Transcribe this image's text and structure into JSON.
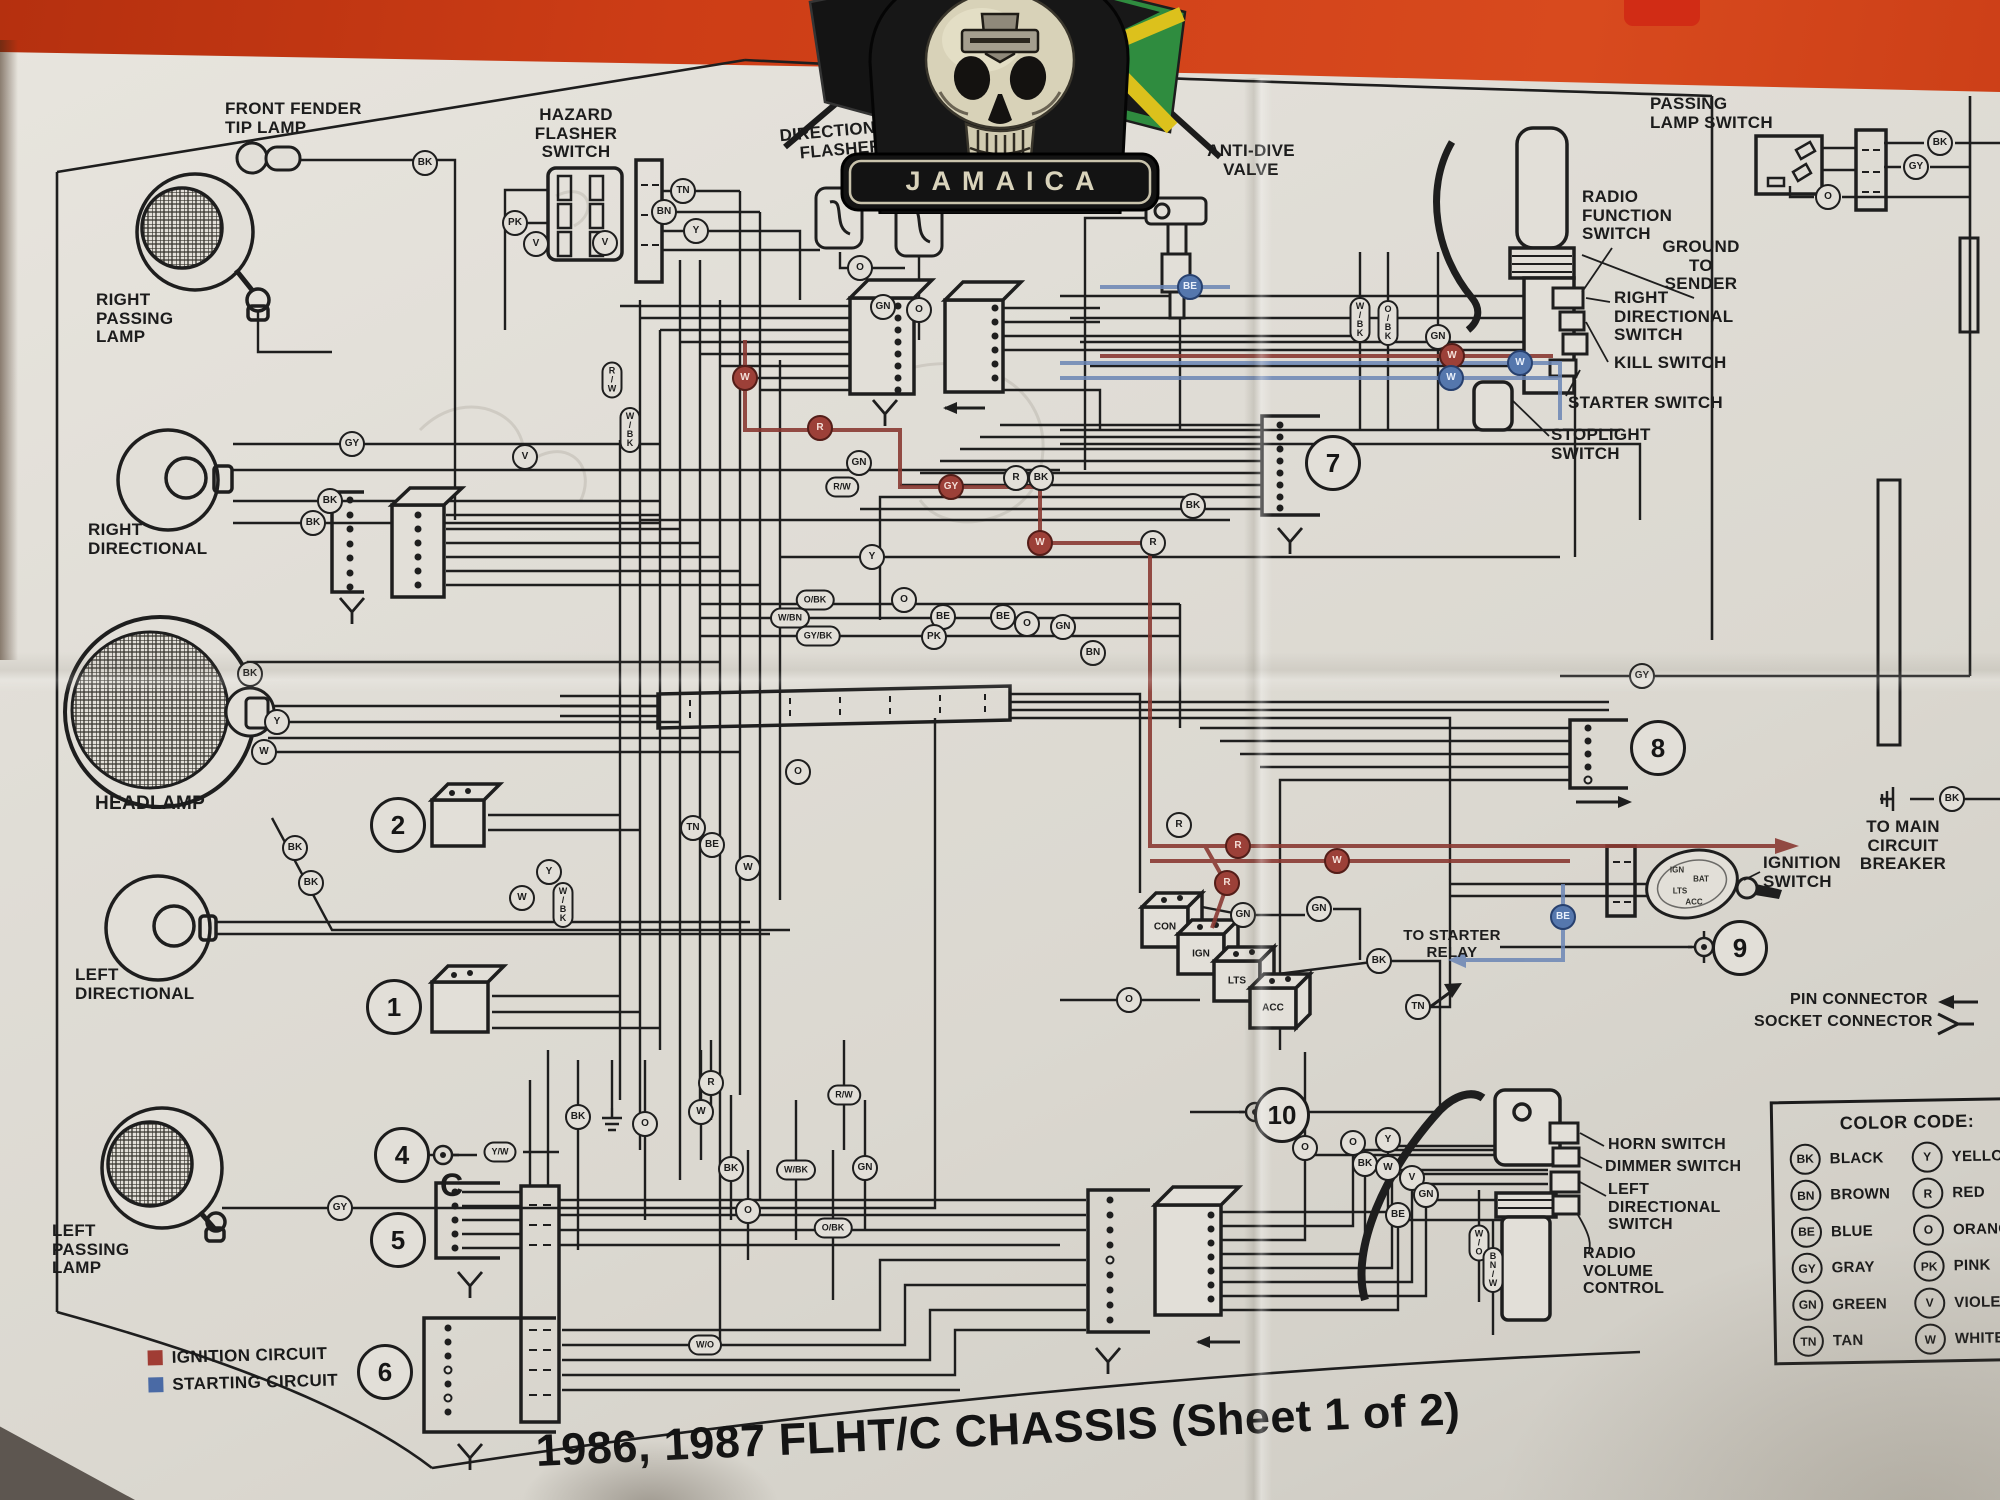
{
  "photo": {
    "background_color": "#cd3d16",
    "paper_color": "#e0ddd6",
    "ink_color": "#1e1e1e"
  },
  "patch": {
    "banner_text": "JAMAICA"
  },
  "title": {
    "text": "1986, 1987 FLHT/C CHASSIS (Sheet 1 of 2)"
  },
  "legend": {
    "items": [
      {
        "label": "IGNITION CIRCUIT",
        "color": "#a03c34"
      },
      {
        "label": "STARTING CIRCUIT",
        "color": "#4a6aa5"
      }
    ]
  },
  "color_code": {
    "title": "COLOR CODE:",
    "left": [
      [
        "BK",
        "BLACK"
      ],
      [
        "BN",
        "BROWN"
      ],
      [
        "BE",
        "BLUE"
      ],
      [
        "GY",
        "GRAY"
      ],
      [
        "GN",
        "GREEN"
      ],
      [
        "TN",
        "TAN"
      ]
    ],
    "right": [
      [
        "Y",
        "YELLOW"
      ],
      [
        "R",
        "RED"
      ],
      [
        "O",
        "ORANGE"
      ],
      [
        "PK",
        "PINK"
      ],
      [
        "V",
        "VIOLET"
      ],
      [
        "W",
        "WHITE"
      ]
    ]
  },
  "ignition_switch": {
    "terminals": [
      "IGN",
      "BAT",
      "LTS",
      "ACC"
    ]
  },
  "key_switch_terminals": [
    "CON",
    "IGN",
    "LTS",
    "ACC"
  ],
  "component_labels": [
    {
      "n": "front-fender-tip-lamp-label",
      "t": "FRONT FENDER\nTIP LAMP",
      "x": 225,
      "y": 100,
      "fs": 17,
      "al": "l"
    },
    {
      "n": "hazard-flasher-switch-label",
      "t": "HAZARD\nFLASHER\nSWITCH",
      "x": 576,
      "y": 106,
      "fs": 17,
      "al": "c"
    },
    {
      "n": "directional-flasher-label",
      "t": "DIRECTIONAL\nFLASHER",
      "x": 840,
      "y": 122,
      "fs": 17,
      "al": "c",
      "rot": -5
    },
    {
      "n": "hazard-flasher-label",
      "t": "HAZARD\nFLASHER",
      "x": 950,
      "y": 134,
      "fs": 17,
      "al": "c",
      "rot": -7
    },
    {
      "n": "anti-dive-valve-label",
      "t": "ANTI-DIVE\nVALVE",
      "x": 1251,
      "y": 142,
      "fs": 17,
      "al": "c"
    },
    {
      "n": "passing-lamp-switch-label",
      "t": "PASSING\nLAMP SWITCH",
      "x": 1650,
      "y": 95,
      "fs": 17,
      "al": "l"
    },
    {
      "n": "radio-function-switch-label",
      "t": "RADIO\nFUNCTION\nSWITCH",
      "x": 1582,
      "y": 188,
      "fs": 17,
      "al": "l"
    },
    {
      "n": "ground-to-sender-label",
      "t": "GROUND\nTO\nSENDER",
      "x": 1701,
      "y": 238,
      "fs": 17,
      "al": "c"
    },
    {
      "n": "right-directional-switch-label",
      "t": "RIGHT\nDIRECTIONAL\nSWITCH",
      "x": 1614,
      "y": 289,
      "fs": 17,
      "al": "l"
    },
    {
      "n": "kill-switch-label",
      "t": "KILL SWITCH",
      "x": 1614,
      "y": 354,
      "fs": 17,
      "al": "l"
    },
    {
      "n": "starter-switch-label",
      "t": "STARTER SWITCH",
      "x": 1568,
      "y": 394,
      "fs": 17,
      "al": "l"
    },
    {
      "n": "stoplight-switch-label",
      "t": "STOPLIGHT\nSWITCH",
      "x": 1551,
      "y": 426,
      "fs": 17,
      "al": "l"
    },
    {
      "n": "right-passing-lamp-label",
      "t": "RIGHT\nPASSING\nLAMP",
      "x": 96,
      "y": 291,
      "fs": 17,
      "al": "l"
    },
    {
      "n": "right-directional-label",
      "t": "RIGHT\nDIRECTIONAL",
      "x": 88,
      "y": 521,
      "fs": 17,
      "al": "l"
    },
    {
      "n": "headlamp-label",
      "t": "HEADLAMP",
      "x": 95,
      "y": 794,
      "fs": 19,
      "al": "l"
    },
    {
      "n": "left-directional-label",
      "t": "LEFT\nDIRECTIONAL",
      "x": 75,
      "y": 966,
      "fs": 17,
      "al": "l"
    },
    {
      "n": "left-passing-lamp-label",
      "t": "LEFT\nPASSING\nLAMP",
      "x": 52,
      "y": 1222,
      "fs": 17,
      "al": "l"
    },
    {
      "n": "horn-switch-label",
      "t": "HORN SWITCH",
      "x": 1608,
      "y": 1136,
      "fs": 16,
      "al": "l"
    },
    {
      "n": "dimmer-switch-label",
      "t": "DIMMER SWITCH",
      "x": 1605,
      "y": 1158,
      "fs": 16,
      "al": "l"
    },
    {
      "n": "left-directional-switch-label",
      "t": "LEFT\nDIRECTIONAL\nSWITCH",
      "x": 1608,
      "y": 1181,
      "fs": 16,
      "al": "l"
    },
    {
      "n": "radio-volume-control-label",
      "t": "RADIO\nVOLUME\nCONTROL",
      "x": 1583,
      "y": 1245,
      "fs": 16,
      "al": "l"
    },
    {
      "n": "to-main-circuit-breaker-label",
      "t": "TO MAIN\nCIRCUIT BREAKER",
      "x": 1903,
      "y": 818,
      "fs": 17,
      "al": "c"
    },
    {
      "n": "ignition-switch-label",
      "t": "IGNITION\nSWITCH",
      "x": 1763,
      "y": 854,
      "fs": 17,
      "al": "l"
    },
    {
      "n": "pin-connector-label",
      "t": "PIN CONNECTOR",
      "x": 1790,
      "y": 991,
      "fs": 16,
      "al": "l"
    },
    {
      "n": "socket-connector-label",
      "t": "SOCKET CONNECTOR",
      "x": 1754,
      "y": 1013,
      "fs": 16,
      "al": "l"
    },
    {
      "n": "to-starter-relay-label",
      "t": "TO STARTER\nRELAY",
      "x": 1452,
      "y": 928,
      "fs": 15,
      "al": "c"
    },
    {
      "n": "c-marker",
      "t": "C",
      "x": 440,
      "y": 1168,
      "fs": 32,
      "al": "l"
    }
  ],
  "wire_labels": [
    {
      "c": "BK",
      "x": 425,
      "y": 163
    },
    {
      "c": "PK",
      "x": 515,
      "y": 223
    },
    {
      "c": "V",
      "x": 536,
      "y": 244
    },
    {
      "c": "V",
      "x": 605,
      "y": 243
    },
    {
      "c": "TN",
      "x": 683,
      "y": 191
    },
    {
      "c": "BN",
      "x": 664,
      "y": 212
    },
    {
      "c": "Y",
      "x": 696,
      "y": 231
    },
    {
      "c": "O",
      "x": 860,
      "y": 268
    },
    {
      "c": "GN",
      "x": 883,
      "y": 307
    },
    {
      "c": "O",
      "x": 919,
      "y": 310
    },
    {
      "c": "BK",
      "x": 1940,
      "y": 143
    },
    {
      "c": "GY",
      "x": 1916,
      "y": 167
    },
    {
      "c": "O",
      "x": 1828,
      "y": 197
    },
    {
      "c": "GY",
      "x": 352,
      "y": 444
    },
    {
      "c": "BK",
      "x": 330,
      "y": 501
    },
    {
      "c": "BK",
      "x": 313,
      "y": 523
    },
    {
      "c": "V",
      "x": 525,
      "y": 457
    },
    {
      "c": "BK",
      "x": 250,
      "y": 674
    },
    {
      "c": "Y",
      "x": 277,
      "y": 722
    },
    {
      "c": "W",
      "x": 264,
      "y": 752
    },
    {
      "c": "BK",
      "x": 295,
      "y": 848
    },
    {
      "c": "BK",
      "x": 311,
      "y": 883
    },
    {
      "c": "GY",
      "x": 340,
      "y": 1208
    },
    {
      "c": "Y",
      "x": 549,
      "y": 872
    },
    {
      "c": "W",
      "x": 522,
      "y": 898
    },
    {
      "c": "TN",
      "x": 693,
      "y": 828
    },
    {
      "c": "O",
      "x": 798,
      "y": 772
    },
    {
      "c": "BE",
      "x": 712,
      "y": 845
    },
    {
      "c": "W",
      "x": 748,
      "y": 868
    },
    {
      "c": "GN",
      "x": 859,
      "y": 463
    },
    {
      "c": "Y",
      "x": 872,
      "y": 557
    },
    {
      "c": "O",
      "x": 904,
      "y": 600
    },
    {
      "c": "BE",
      "x": 943,
      "y": 617
    },
    {
      "c": "PK",
      "x": 934,
      "y": 637
    },
    {
      "c": "BE",
      "x": 1003,
      "y": 617
    },
    {
      "c": "O",
      "x": 1027,
      "y": 624
    },
    {
      "c": "GN",
      "x": 1063,
      "y": 627
    },
    {
      "c": "BN",
      "x": 1093,
      "y": 653
    },
    {
      "c": "R",
      "x": 1016,
      "y": 478
    },
    {
      "c": "BK",
      "x": 1041,
      "y": 478
    },
    {
      "c": "BK",
      "x": 1193,
      "y": 506
    },
    {
      "c": "R",
      "x": 1153,
      "y": 543
    },
    {
      "c": "GN",
      "x": 1438,
      "y": 337
    },
    {
      "c": "R",
      "x": 1179,
      "y": 825
    },
    {
      "c": "GN",
      "x": 1243,
      "y": 915
    },
    {
      "c": "GN",
      "x": 1319,
      "y": 909
    },
    {
      "c": "BK",
      "x": 1379,
      "y": 961
    },
    {
      "c": "O",
      "x": 1129,
      "y": 1000
    },
    {
      "c": "TN",
      "x": 1418,
      "y": 1007
    },
    {
      "c": "BK",
      "x": 1952,
      "y": 799
    },
    {
      "c": "GY",
      "x": 1642,
      "y": 676
    },
    {
      "c": "O",
      "x": 1305,
      "y": 1148
    },
    {
      "c": "O",
      "x": 1353,
      "y": 1143
    },
    {
      "c": "Y",
      "x": 1388,
      "y": 1140
    },
    {
      "c": "BK",
      "x": 1365,
      "y": 1164
    },
    {
      "c": "W",
      "x": 1388,
      "y": 1168
    },
    {
      "c": "V",
      "x": 1412,
      "y": 1178
    },
    {
      "c": "GN",
      "x": 1426,
      "y": 1195
    },
    {
      "c": "BE",
      "x": 1398,
      "y": 1215
    },
    {
      "c": "BK",
      "x": 578,
      "y": 1117
    },
    {
      "c": "O",
      "x": 645,
      "y": 1124
    },
    {
      "c": "W",
      "x": 701,
      "y": 1112
    },
    {
      "c": "R",
      "x": 711,
      "y": 1083
    },
    {
      "c": "BK",
      "x": 731,
      "y": 1169
    },
    {
      "c": "GN",
      "x": 865,
      "y": 1168
    },
    {
      "c": "O",
      "x": 748,
      "y": 1211
    },
    {
      "c": "R/W",
      "x": 842,
      "y": 487,
      "s": "p"
    },
    {
      "c": "Y/W",
      "x": 500,
      "y": 1152,
      "s": "p"
    },
    {
      "c": "W/O",
      "x": 705,
      "y": 1345,
      "s": "p"
    },
    {
      "c": "R/W",
      "x": 844,
      "y": 1095,
      "s": "p"
    },
    {
      "c": "W/BK",
      "x": 796,
      "y": 1170,
      "s": "p"
    },
    {
      "c": "O/BK",
      "x": 833,
      "y": 1228,
      "s": "p"
    },
    {
      "c": "O/BK",
      "x": 815,
      "y": 600,
      "s": "p"
    },
    {
      "c": "W/BN",
      "x": 790,
      "y": 618,
      "s": "p"
    },
    {
      "c": "GY/BK",
      "x": 818,
      "y": 636,
      "s": "p"
    },
    {
      "c": "W/BK",
      "x": 1360,
      "y": 320,
      "s": "v"
    },
    {
      "c": "O/BK",
      "x": 1388,
      "y": 323,
      "s": "v"
    },
    {
      "c": "W/O",
      "x": 1479,
      "y": 1243,
      "s": "v"
    },
    {
      "c": "BN/W",
      "x": 1493,
      "y": 1270,
      "s": "v"
    },
    {
      "c": "R/W",
      "x": 612,
      "y": 380,
      "s": "v"
    },
    {
      "c": "W/BK",
      "x": 630,
      "y": 430,
      "s": "v"
    },
    {
      "c": "W/BK",
      "x": 563,
      "y": 905,
      "s": "v"
    },
    {
      "c": "W",
      "x": 745,
      "y": 378,
      "k": "red"
    },
    {
      "c": "R",
      "x": 820,
      "y": 428,
      "k": "red"
    },
    {
      "c": "GY",
      "x": 951,
      "y": 487,
      "k": "red"
    },
    {
      "c": "W",
      "x": 1040,
      "y": 543,
      "k": "red"
    },
    {
      "c": "W",
      "x": 1452,
      "y": 356,
      "k": "red"
    },
    {
      "c": "R",
      "x": 1238,
      "y": 846,
      "k": "red"
    },
    {
      "c": "W",
      "x": 1337,
      "y": 861,
      "k": "red"
    },
    {
      "c": "R",
      "x": 1227,
      "y": 883,
      "k": "red"
    },
    {
      "c": "W",
      "x": 1520,
      "y": 363,
      "k": "blue"
    },
    {
      "c": "W",
      "x": 1451,
      "y": 378,
      "k": "blue"
    },
    {
      "c": "BE",
      "x": 1190,
      "y": 287,
      "k": "blue"
    },
    {
      "c": "BE",
      "x": 1563,
      "y": 917,
      "k": "blue"
    }
  ],
  "circled_numbers": [
    {
      "v": "1",
      "x": 394,
      "y": 1007
    },
    {
      "v": "2",
      "x": 398,
      "y": 825
    },
    {
      "v": "4",
      "x": 402,
      "y": 1155
    },
    {
      "v": "5",
      "x": 398,
      "y": 1240
    },
    {
      "v": "6",
      "x": 385,
      "y": 1372
    },
    {
      "v": "7",
      "x": 1333,
      "y": 463
    },
    {
      "v": "8",
      "x": 1658,
      "y": 748
    },
    {
      "v": "9",
      "x": 1740,
      "y": 948
    },
    {
      "v": "10",
      "x": 1282,
      "y": 1115
    }
  ]
}
